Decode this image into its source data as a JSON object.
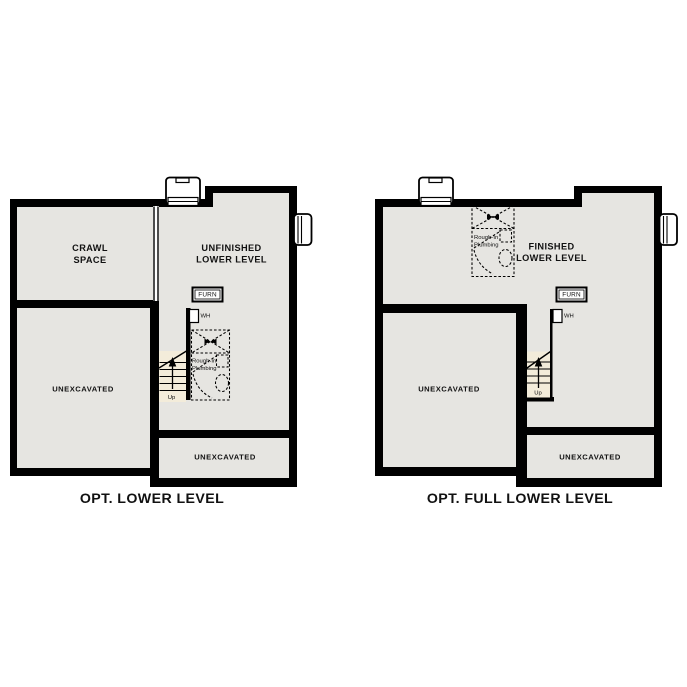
{
  "colors": {
    "wall": "#000000",
    "room_fill": "#e6e5e1",
    "stair_fill": "#f3ecda",
    "fixture_fill": "#ffffff",
    "label": "#111111"
  },
  "plans": [
    {
      "caption": "OPT. LOWER LEVEL",
      "rooms": {
        "crawl_space": {
          "line1": "CRAWL",
          "line2": "SPACE"
        },
        "main": {
          "line1": "UNFINISHED",
          "line2": "LOWER LEVEL"
        },
        "side_unexcavated": "UNEXCAVATED",
        "bottom_unexcavated": "UNEXCAVATED"
      },
      "fixtures": {
        "furnace": "FURN",
        "water_heater": "WH",
        "plumbing_line1": "Rough-In",
        "plumbing_line2": "Plumbing",
        "stairs_direction": "Up"
      }
    },
    {
      "caption": "OPT. FULL LOWER LEVEL",
      "rooms": {
        "main": {
          "line1": "FINISHED",
          "line2": "LOWER LEVEL"
        },
        "side_unexcavated": "UNEXCAVATED",
        "bottom_unexcavated": "UNEXCAVATED"
      },
      "fixtures": {
        "furnace": "FURN",
        "water_heater": "WH",
        "plumbing_line1": "Rough-In",
        "plumbing_line2": "Plumbing",
        "stairs_direction": "Up"
      }
    }
  ]
}
